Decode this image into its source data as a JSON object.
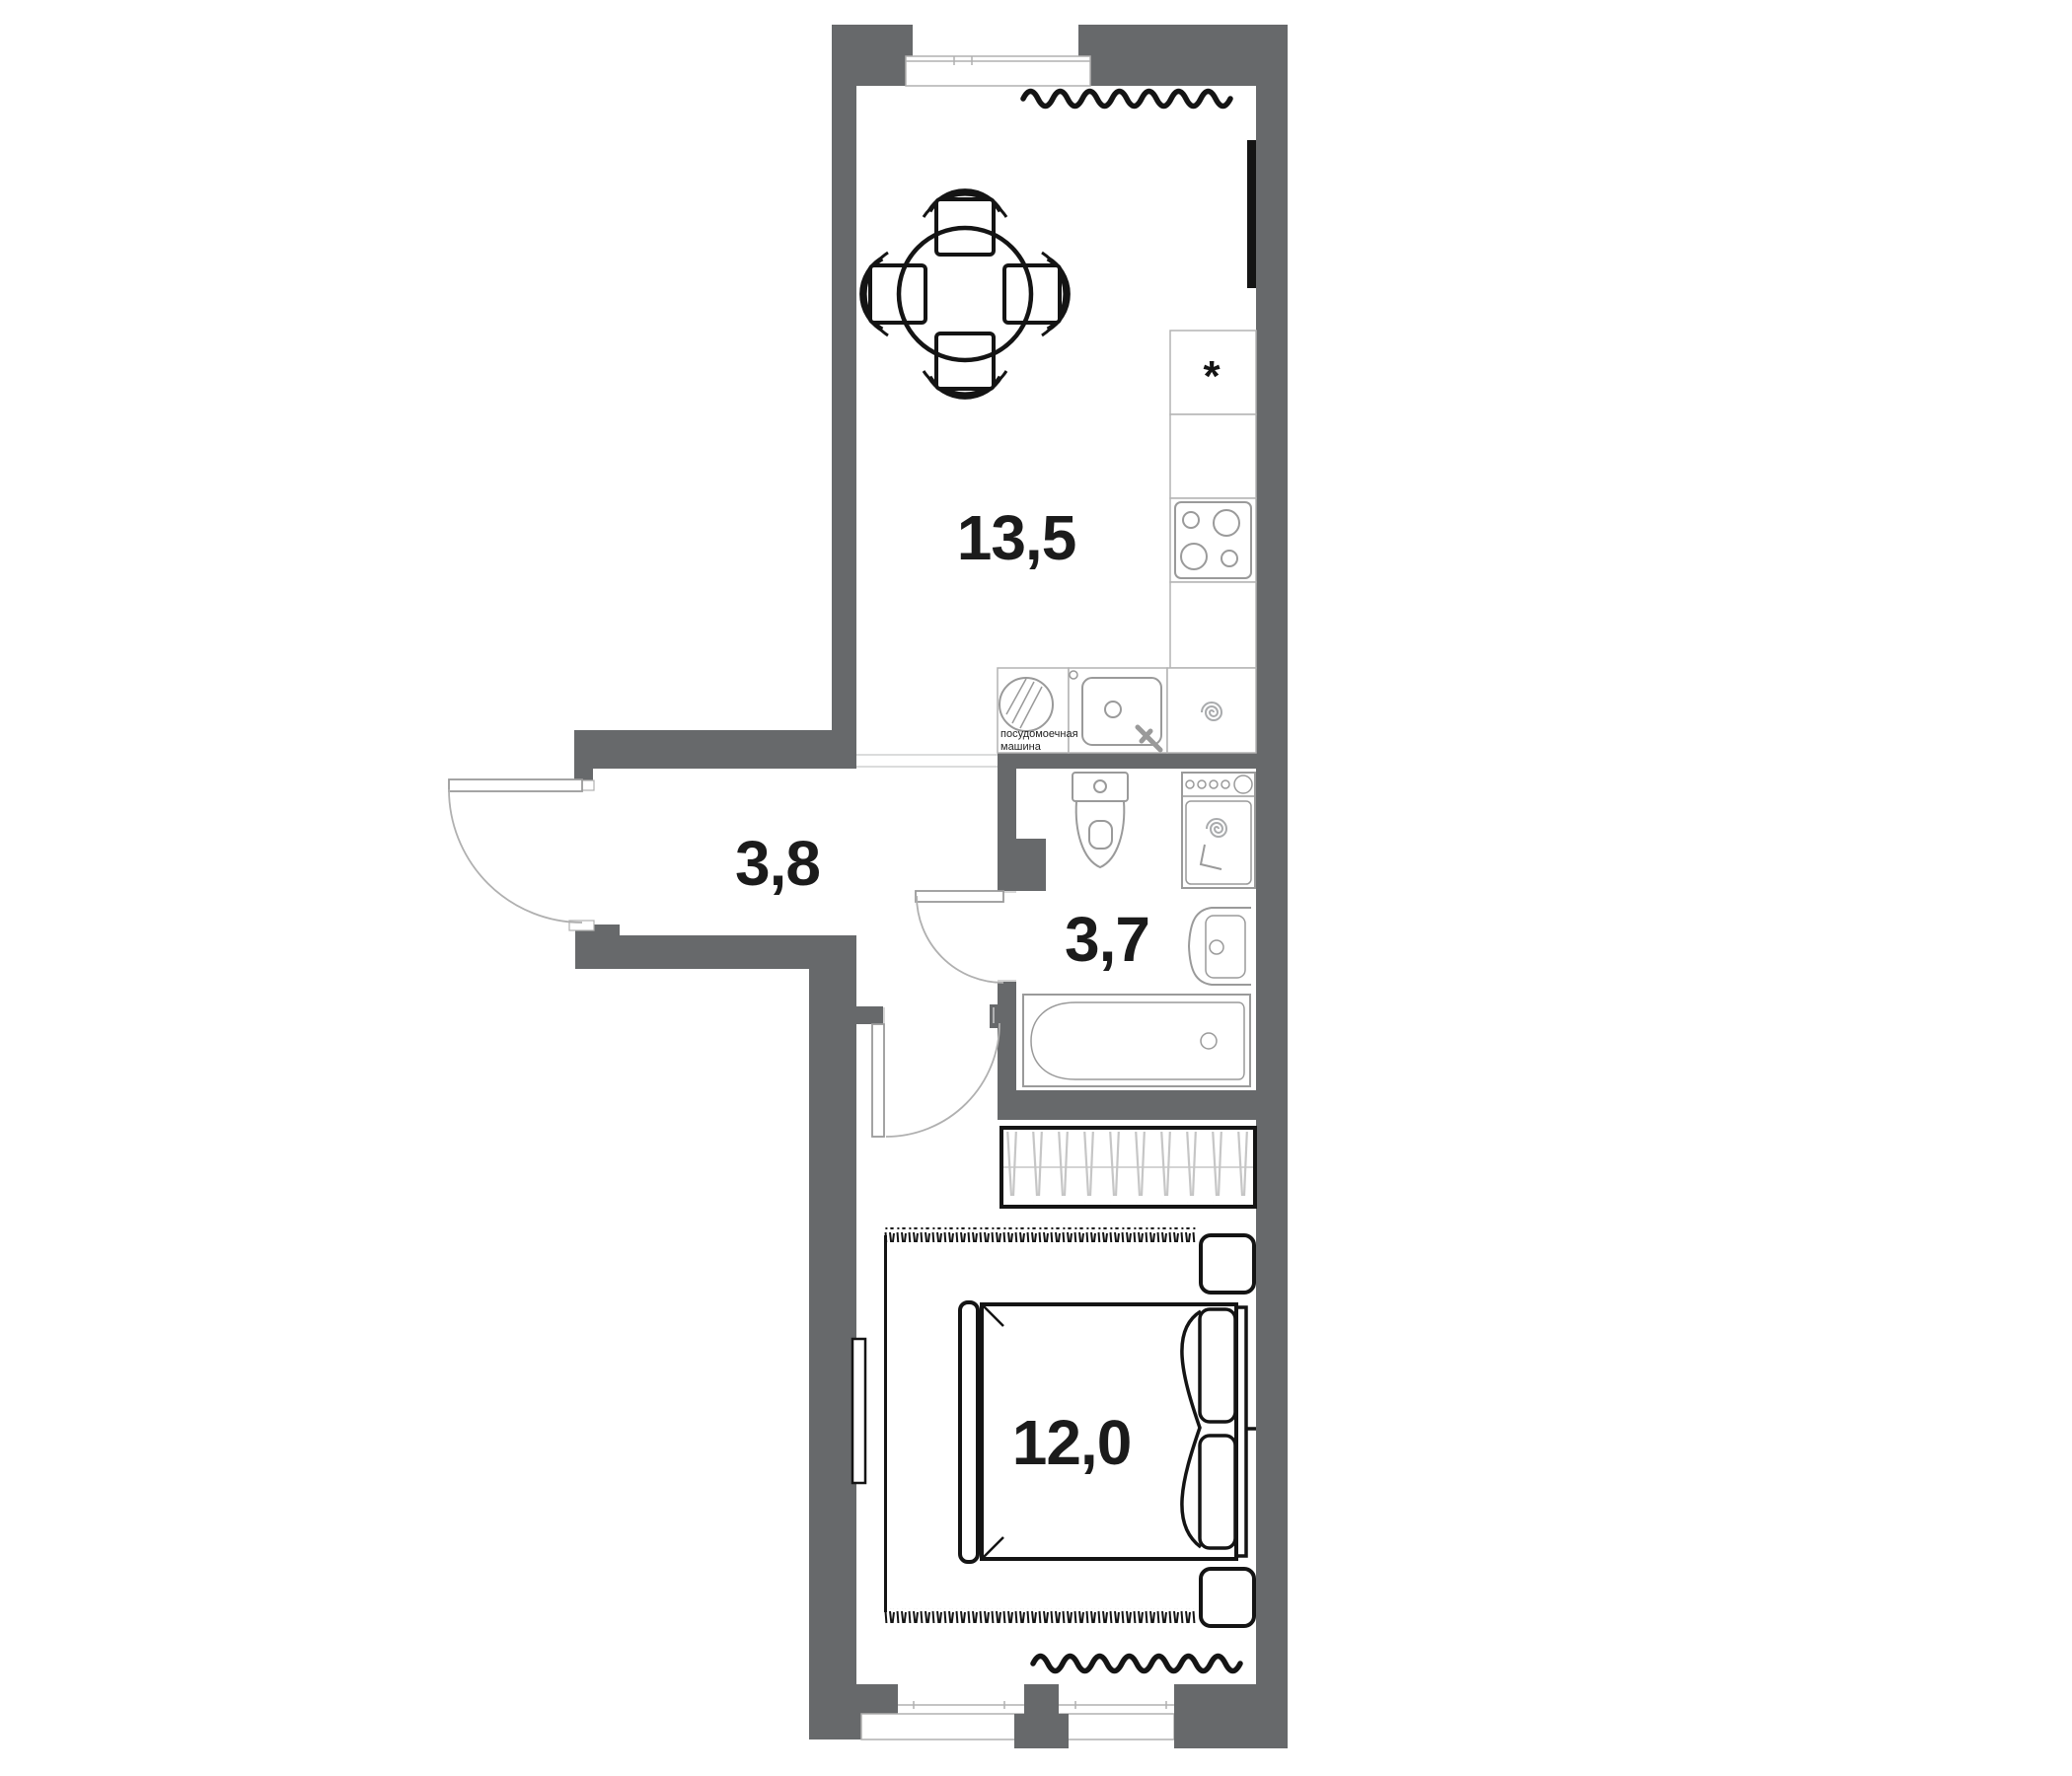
{
  "plan_title": "apartment floor plan",
  "rooms": [
    {
      "id": "kitchen-living",
      "area": "13,5"
    },
    {
      "id": "hallway",
      "area": "3,8"
    },
    {
      "id": "bathroom",
      "area": "3,7"
    },
    {
      "id": "bedroom",
      "area": "12,0"
    }
  ],
  "annotations": {
    "dishwasher_line1": "посудомоечная",
    "dishwasher_line2": "машина",
    "fridge_mark": "*"
  },
  "colors": {
    "wall": "#67696b",
    "fixture_outline": "#a9abad",
    "furniture": "#141414",
    "background": "#ffffff",
    "label_text": "#1b1b1b"
  }
}
